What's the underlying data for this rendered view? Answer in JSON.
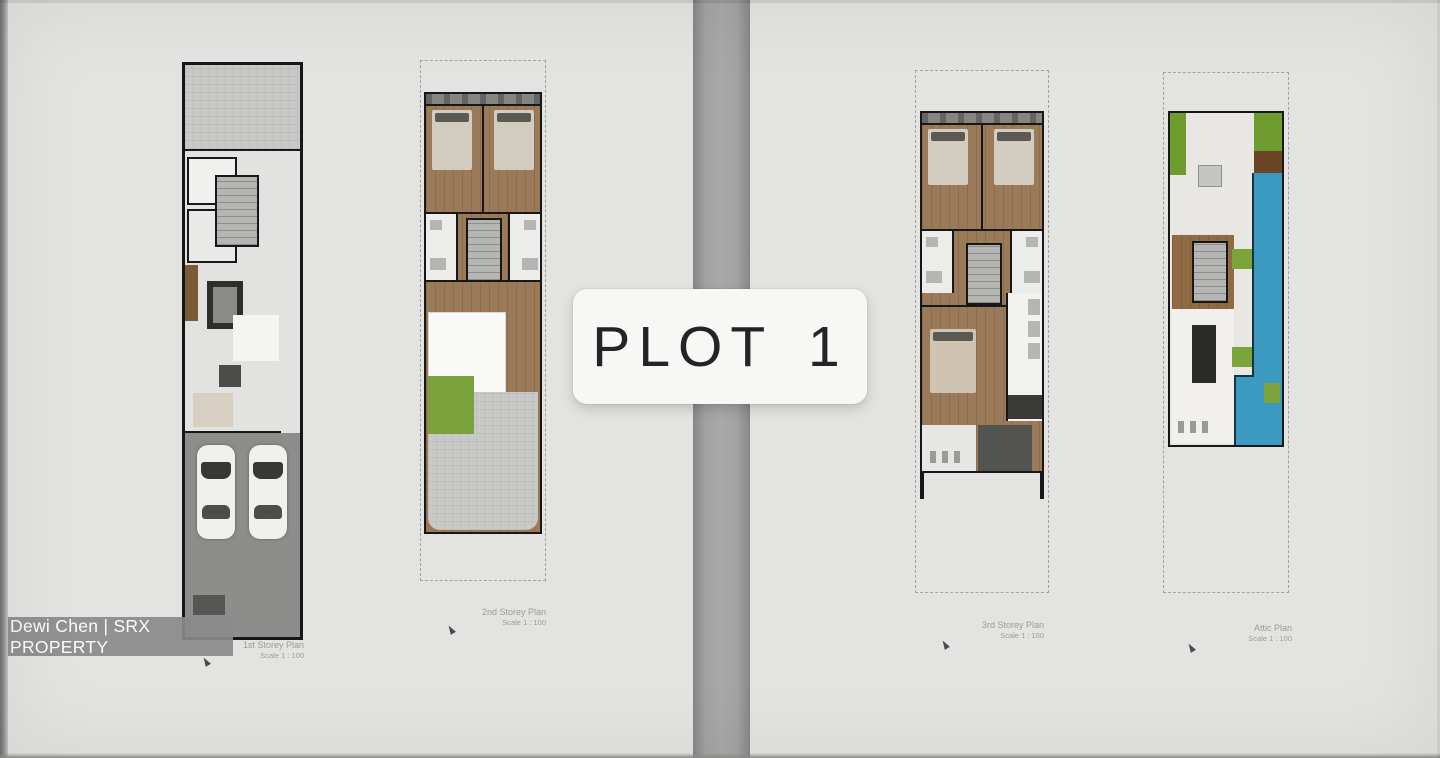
{
  "plot_label": "PLOT 1",
  "watermark": "Dewi Chen | SRX PROPERTY",
  "plans": [
    {
      "title": "1st Storey Plan",
      "scale": "Scale 1 : 100"
    },
    {
      "title": "2nd Storey Plan",
      "scale": "Scale 1 : 100"
    },
    {
      "title": "3rd Storey Plan",
      "scale": "Scale 1 : 100"
    },
    {
      "title": "Attic Plan",
      "scale": "Scale 1 : 100"
    }
  ],
  "colors": {
    "background": "#e3e3e1",
    "fold_bar": "#a2a2a2",
    "plot_label_bg": "#f7f7f5",
    "plot_label_text": "#242424",
    "watermark_bg": "#8a8a8a",
    "watermark_text": "#fcfcfc",
    "wall": "#171717",
    "wood_floor": "#9a7a58",
    "driveway": "#8d8d8b",
    "paving": "#c9c9c7",
    "grass": "#79a23b",
    "pool_water": "#3a9abf",
    "timber_deck": "#6b4426",
    "caption_text": "#9b9b9b"
  }
}
